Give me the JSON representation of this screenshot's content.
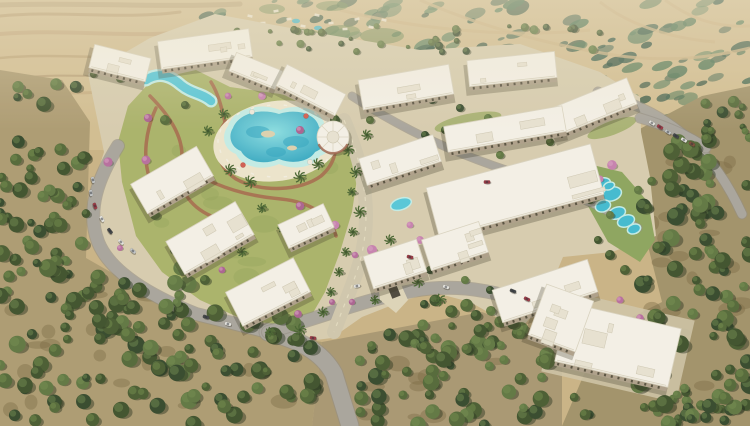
{
  "meta": {
    "width": 750,
    "height": 426,
    "kind": "aerial-3d-render-residential-compound"
  },
  "palette": {
    "sand": "#c9b184",
    "sandLight": "#dcc9a0",
    "sandDark": "#a8885c",
    "grove": "#ab9970",
    "groveB": "#a79570",
    "groveC": "#a09068",
    "groveDark": "#75653f",
    "treeGreens": [
      "#3b4e2a",
      "#46592f",
      "#516636",
      "#5d7440",
      "#32462a"
    ],
    "treeHi": "#748f4d",
    "mottleGreens": [
      "#3f6450",
      "#4e7556",
      "#35594a",
      "#5d8160",
      "#2c4f40"
    ],
    "lawn": "#a8b168",
    "lawnDark": "#8fa156",
    "lawnRight": "#8ba35c",
    "pool": "#54c6d8",
    "poolDeep": "#2fa3c0",
    "poolRim": "#c2ebe6",
    "poolLight": "#8adde2",
    "deck": "#ece4cc",
    "deckLight": "#f0e9d6",
    "path": "#a4654a",
    "road": "#a7a39b",
    "roadDark": "#8f8b82",
    "boulevard": "#cfc6ac",
    "roofWhite": "#f4f0e7",
    "roofEdge": "#d9d2c0",
    "roofDetail": "#e7e1d1",
    "facade": "#ac9e88",
    "windowDark": "#544d3d",
    "pinks": [
      "#b66b9d",
      "#c67fae",
      "#a95f90"
    ],
    "pinkHi": "#d79ec2",
    "carColors": {
      "sil": "#c3c6c8",
      "whi": "#e6e5e1",
      "red": "#993341",
      "dk": "#3e4144",
      "brn": "#7d4a38"
    },
    "shadow": "rgba(50,45,30,0.28)",
    "treeShadow": "#222c18"
  },
  "scene": {
    "desertStreaks": [
      {
        "d": "M0,16 C60,10 120,20 180,12",
        "c": "#a8885c",
        "w": 3,
        "o": 0.5
      },
      {
        "d": "M0,34 C70,28 140,40 200,30",
        "c": "#b5956a",
        "w": 4,
        "o": 0.45
      },
      {
        "d": "M0,58 C60,52 120,62 170,54",
        "c": "#a8885c",
        "w": 2.5,
        "o": 0.4
      },
      {
        "d": "M20,78 C70,72 120,80 160,74",
        "c": "#8f7450",
        "w": 2,
        "o": 0.35
      },
      {
        "d": "M0,5 C80,2 160,8 240,4",
        "c": "#8f7450",
        "w": 5,
        "o": 0.3
      },
      {
        "d": "M0,96 C40,90 80,96 120,90",
        "c": "#b5956a",
        "w": 3,
        "o": 0.35
      }
    ],
    "mottleClip": "180,0 750,0 750,120 640,132 470,72 300,44 180,32",
    "mottleZones": [
      {
        "x": 330,
        "y": 0,
        "w": 420,
        "h": 66,
        "n": 70,
        "rmin": 3,
        "rmax": 13
      },
      {
        "x": 590,
        "y": 55,
        "w": 160,
        "h": 75,
        "n": 32,
        "rmin": 3,
        "rmax": 11
      },
      {
        "x": 195,
        "y": 0,
        "w": 150,
        "h": 42,
        "n": 20,
        "rmin": 2,
        "rmax": 8
      }
    ],
    "distantRoads": [
      "M340,10 C420,30 510,38 590,30",
      "M420,0 C470,22 540,44 620,56 C670,62 710,58 750,48",
      "M600,2 C625,22 665,38 715,42",
      "M665,0 C690,18 715,28 750,26",
      "M260,28 C300,40 340,44 380,42"
    ],
    "resortGreens": [
      [
        262,
        31,
        16,
        6
      ],
      [
        302,
        36,
        20,
        7
      ],
      [
        342,
        31,
        18,
        6
      ],
      [
        382,
        36,
        22,
        8
      ],
      [
        272,
        9,
        13,
        5
      ],
      [
        332,
        6,
        16,
        5
      ]
    ],
    "resortSpecks": [
      [
        250,
        16
      ],
      [
        263,
        23
      ],
      [
        276,
        11
      ],
      [
        289,
        19
      ],
      [
        303,
        26
      ],
      [
        317,
        15
      ],
      [
        331,
        23
      ],
      [
        345,
        29
      ],
      [
        357,
        19
      ],
      [
        371,
        27
      ],
      [
        238,
        24
      ],
      [
        384,
        20
      ]
    ],
    "resortPools": [
      [
        296,
        21
      ],
      [
        318,
        28
      ]
    ],
    "groveBases": [
      {
        "pts": "0,70 62,80 90,122 86,258 142,290 202,316 252,330 322,342 312,426 0,426",
        "fill": "grove"
      },
      {
        "pts": "322,342 482,312 562,342 562,426 312,426",
        "fill": "groveB"
      },
      {
        "pts": "634,132 702,96 750,86 750,426 562,426 602,332 662,302 647,242 632,182",
        "fill": "groveC"
      }
    ],
    "groundPatchZones": [
      {
        "x": 10,
        "y": 280,
        "w": 280,
        "h": 130,
        "n": 22
      },
      {
        "x": 360,
        "y": 340,
        "w": 170,
        "h": 80,
        "n": 12
      },
      {
        "x": 650,
        "y": 160,
        "w": 95,
        "h": 250,
        "n": 20
      }
    ],
    "compoundBase": "88,74 150,38 215,14 312,32 420,50 520,44 600,72 640,97 641,132 650,177 656,236 612,252 563,257 545,300 520,330 470,302 432,292 400,302 362,317 332,338 300,342 252,330 196,312 142,290 100,250 88,202 104,152",
    "diamondPad": {
      "x": 618,
      "y": 346,
      "w": 138,
      "h": 84,
      "r": 13
    },
    "lawnMain": "128,106 152,80 196,70 230,87 280,94 330,107 352,132 358,172 352,212 340,252 325,292 310,318 282,326 240,318 200,300 162,272 136,236 122,182 118,142",
    "lawnTextureZone": {
      "x": 150,
      "y": 90,
      "w": 180,
      "h": 210,
      "n": 14
    },
    "lawnRightPoly": "580,162 622,172 648,202 655,240 640,262 608,242 588,206",
    "lawnStrips": [
      [
        468,
        122,
        34,
        8,
        -12
      ],
      [
        556,
        162,
        36,
        9,
        -16
      ],
      [
        476,
        208,
        42,
        9,
        -15
      ],
      [
        612,
        128,
        26,
        7,
        -20
      ]
    ],
    "terracottaPaths": [
      "M150,96 C170,116 186,140 181,164 C177,188 189,206 211,216",
      "M211,82 C226,106 223,136 239,159",
      "M226,121 C211,141 216,166 236,179 C261,193 301,191 321,176 C336,163 339,146 331,131",
      "M181,164 C211,186 246,196 281,199 C311,202 331,216 336,236",
      "M156,108 C146,130 142,156 150,180"
    ],
    "roads": [
      {
        "d": "M118,146 C98,178 86,210 98,242 C110,272 150,296 196,314 L268,332",
        "w": 12
      },
      {
        "d": "M268,332 C300,340 322,352 334,374 L350,426",
        "w": 17
      },
      {
        "d": "M268,332 C320,318 362,300 412,291 C452,284 482,289 514,298 C538,305 552,320 562,336",
        "w": 12
      },
      {
        "d": "M598,92 C640,104 668,120 692,142 C716,164 731,190 742,214",
        "w": 9
      },
      {
        "d": "M352,96 C400,128 452,152 506,170 C560,188 602,206 638,228",
        "w": 7
      },
      {
        "d": "M640,118 C666,126 690,136 706,148",
        "w": 9
      }
    ],
    "boulevard": {
      "d": "M344,120 C362,162 370,202 364,242 C360,270 348,294 334,332",
      "w": 14
    },
    "ramp": {
      "pts": "377,272 393,267 408,300 396,313 380,300",
      "slot": [
        392,
        286,
        9,
        24,
        -22
      ]
    },
    "lagoon": {
      "deck": [
        277,
        141,
        64,
        40,
        -8
      ],
      "rim": "M228,126 C234,108 260,102 280,110 C300,102 322,110 325,126 C338,133 336,150 320,156 C315,167 294,171 279,164 C261,172 241,166 236,154 C223,149 221,135 228,126 Z",
      "water": "M233,128 C239,113 261,108 279,114 C297,108 316,114 319,127 C330,133 328,147 315,152 C310,161 293,165 279,159 C263,166 246,161 241,151 C230,147 228,135 233,128 Z",
      "deep": [
        [
          258,
          132,
          12,
          6
        ],
        [
          296,
          142,
          13,
          6
        ],
        [
          276,
          152,
          10,
          5
        ]
      ],
      "islands": [
        [
          268,
          134,
          7,
          3.5
        ],
        [
          292,
          148,
          5,
          2.5
        ]
      ],
      "umbrellas": [
        [
          243,
          165,
          "#d05a4e"
        ],
        [
          310,
          162,
          "#efe9dc"
        ],
        [
          252,
          112,
          "#efe9dc"
        ],
        [
          306,
          116,
          "#d05a4e"
        ]
      ]
    },
    "windingPool": {
      "d": "M146,80 C160,71 172,77 181,85 C192,94 202,93 211,101",
      "rimW": 13,
      "waterW": 8.5
    },
    "smallPools": [
      [
        401,
        204,
        10,
        5,
        -18
      ]
    ],
    "aquaBlobs": [
      [
        602,
        184,
        8,
        5
      ],
      [
        612,
        194,
        9,
        6
      ],
      [
        603,
        206,
        7,
        5
      ],
      [
        617,
        213,
        8,
        5
      ],
      [
        626,
        221,
        8,
        5
      ],
      [
        634,
        229,
        6,
        4
      ],
      [
        609,
        186,
        5,
        3
      ]
    ],
    "clubhouse": {
      "x": 333,
      "y": 137,
      "r": 16
    },
    "treeZones": [
      {
        "x": 0,
        "y": 72,
        "w": 88,
        "h": 190,
        "n": 42,
        "rmin": 3.5,
        "rmax": 8
      },
      {
        "x": 0,
        "y": 250,
        "w": 190,
        "h": 176,
        "n": 90,
        "rmin": 4,
        "rmax": 9
      },
      {
        "x": 185,
        "y": 312,
        "w": 130,
        "h": 114,
        "n": 42,
        "rmin": 4,
        "rmax": 8.5
      },
      {
        "x": 355,
        "y": 332,
        "w": 195,
        "h": 94,
        "n": 55,
        "rmin": 4,
        "rmax": 8.5
      },
      {
        "x": 545,
        "y": 396,
        "w": 205,
        "h": 30,
        "n": 16,
        "rmin": 4,
        "rmax": 7
      },
      {
        "x": 638,
        "y": 135,
        "w": 112,
        "h": 290,
        "n": 100,
        "rmin": 4,
        "rmax": 9
      },
      {
        "x": 698,
        "y": 92,
        "w": 52,
        "h": 48,
        "n": 12,
        "rmin": 3,
        "rmax": 6
      },
      {
        "x": 196,
        "y": 26,
        "w": 420,
        "h": 26,
        "n": 34,
        "rmin": 2,
        "rmax": 4.5
      },
      {
        "x": 420,
        "y": 298,
        "w": 120,
        "h": 52,
        "n": 26,
        "rmin": 3.5,
        "rmax": 7
      },
      {
        "x": 86,
        "y": 60,
        "w": 60,
        "h": 22,
        "n": 8,
        "rmin": 2.5,
        "rmax": 5
      }
    ],
    "interiorTrees": [
      [
        165,
        120,
        5
      ],
      [
        185,
        105,
        4
      ],
      [
        335,
        120,
        5
      ],
      [
        370,
        120,
        4
      ],
      [
        425,
        135,
        4
      ],
      [
        445,
        130,
        4
      ],
      [
        470,
        148,
        4
      ],
      [
        500,
        155,
        4
      ],
      [
        530,
        170,
        4
      ],
      [
        560,
        185,
        4
      ],
      [
        590,
        200,
        4
      ],
      [
        610,
        215,
        4
      ],
      [
        155,
        215,
        5
      ],
      [
        145,
        195,
        4
      ],
      [
        175,
        250,
        5
      ],
      [
        205,
        280,
        5
      ],
      [
        240,
        300,
        5
      ],
      [
        430,
        270,
        4
      ],
      [
        465,
        280,
        4
      ],
      [
        490,
        290,
        4
      ],
      [
        610,
        255,
        5
      ],
      [
        625,
        270,
        5
      ],
      [
        598,
        240,
        4
      ],
      [
        432,
        100,
        4
      ],
      [
        460,
        108,
        4
      ],
      [
        488,
        118,
        4
      ],
      [
        520,
        130,
        4
      ],
      [
        550,
        142,
        4
      ]
    ],
    "palms": [
      [
        348,
        150
      ],
      [
        356,
        172
      ],
      [
        352,
        192
      ],
      [
        360,
        212
      ],
      [
        353,
        232
      ],
      [
        346,
        252
      ],
      [
        339,
        272
      ],
      [
        331,
        292
      ],
      [
        323,
        312
      ],
      [
        375,
        300
      ],
      [
        390,
        240
      ],
      [
        230,
        170
      ],
      [
        250,
        182
      ],
      [
        300,
        177
      ],
      [
        318,
        164
      ],
      [
        224,
        114
      ],
      [
        208,
        131
      ],
      [
        262,
        208
      ],
      [
        282,
        228
      ],
      [
        242,
        252
      ],
      [
        300,
        330
      ],
      [
        270,
        332
      ],
      [
        418,
        282
      ],
      [
        440,
        300
      ],
      [
        367,
        135
      ]
    ],
    "pinkTrees": [
      [
        148,
        118
      ],
      [
        160,
        196
      ],
      [
        190,
        256
      ],
      [
        222,
        270
      ],
      [
        248,
        306
      ],
      [
        298,
        314
      ],
      [
        332,
        302
      ],
      [
        352,
        302
      ],
      [
        146,
        160
      ],
      [
        108,
        162
      ],
      [
        120,
        248
      ],
      [
        372,
        250
      ],
      [
        420,
        240
      ],
      [
        300,
        130
      ],
      [
        262,
        96
      ],
      [
        228,
        96
      ],
      [
        378,
        170
      ],
      [
        300,
        206
      ],
      [
        588,
        170
      ],
      [
        600,
        179
      ],
      [
        612,
        165
      ],
      [
        620,
        300
      ],
      [
        640,
        318
      ],
      [
        575,
        300
      ],
      [
        410,
        225
      ],
      [
        355,
        255
      ],
      [
        335,
        225
      ]
    ],
    "buildings": [
      [
        120,
        63,
        58,
        24,
        14
      ],
      [
        205,
        49,
        92,
        28,
        -8
      ],
      [
        256,
        71,
        50,
        20,
        22
      ],
      [
        311,
        90,
        66,
        24,
        27
      ],
      [
        406,
        87,
        92,
        30,
        -10
      ],
      [
        512,
        69,
        88,
        26,
        -6
      ],
      [
        592,
        107,
        86,
        28,
        -22
      ],
      [
        505,
        129,
        120,
        26,
        -10
      ],
      [
        515,
        191,
        170,
        52,
        -15
      ],
      [
        545,
        291,
        100,
        34,
        -18
      ],
      [
        400,
        160,
        78,
        28,
        -18
      ],
      [
        455,
        246,
        60,
        32,
        -18
      ],
      [
        172,
        180,
        76,
        34,
        -30
      ],
      [
        210,
        238,
        80,
        38,
        -30
      ],
      [
        268,
        292,
        76,
        38,
        -27
      ],
      [
        306,
        226,
        50,
        26,
        -25
      ],
      [
        395,
        264,
        56,
        34,
        -18
      ],
      [
        618,
        345,
        116,
        60,
        13
      ],
      [
        561,
        318,
        50,
        54,
        20
      ]
    ],
    "cars": [
      [
        93,
        180,
        75,
        "sil"
      ],
      [
        91,
        193,
        80,
        "sil"
      ],
      [
        95,
        206,
        70,
        "red"
      ],
      [
        102,
        219,
        60,
        "whi"
      ],
      [
        110,
        231,
        52,
        "dk"
      ],
      [
        121,
        242,
        45,
        "whi"
      ],
      [
        133,
        251,
        40,
        "sil"
      ],
      [
        206,
        317,
        18,
        "dk"
      ],
      [
        228,
        324,
        14,
        "whi"
      ],
      [
        313,
        338,
        8,
        "red"
      ],
      [
        357,
        286,
        -10,
        "whi"
      ],
      [
        410,
        257,
        15,
        "red"
      ],
      [
        446,
        287,
        20,
        "whi"
      ],
      [
        513,
        291,
        22,
        "dk"
      ],
      [
        527,
        299,
        25,
        "red"
      ],
      [
        652,
        123,
        32,
        "whi"
      ],
      [
        660,
        127,
        32,
        "red"
      ],
      [
        668,
        132,
        32,
        "sil"
      ],
      [
        676,
        136,
        32,
        "dk"
      ],
      [
        684,
        140,
        32,
        "whi"
      ],
      [
        692,
        144,
        32,
        "brn"
      ],
      [
        487,
        182,
        0,
        "red"
      ]
    ]
  }
}
